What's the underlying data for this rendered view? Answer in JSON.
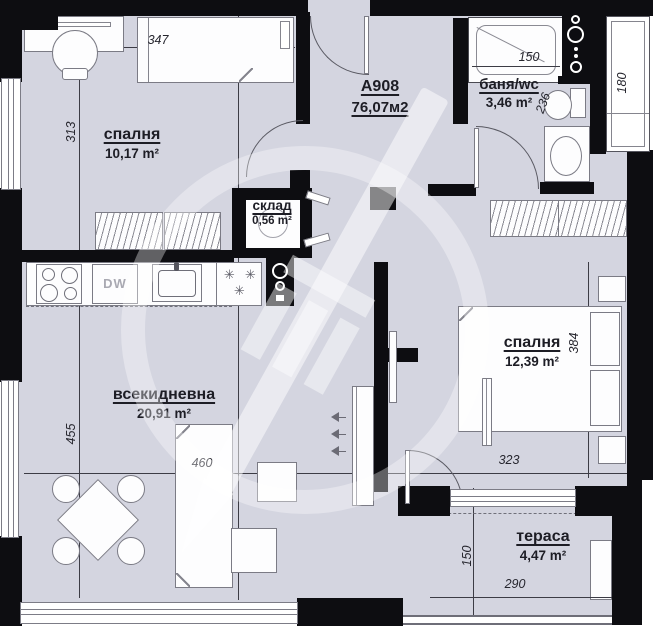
{
  "meta": {
    "plan_code": "A908",
    "total_area": "76,07м2"
  },
  "colors": {
    "wall": "#0d0d11",
    "floor": "#d4d5e0",
    "outline": "#7b7b85",
    "text": "#1d1d25",
    "dim": "#26262e",
    "watermark": "#ffffff"
  },
  "rooms": [
    {
      "id": "bedroom-1",
      "name": "спалня",
      "area": "10,17 m²"
    },
    {
      "id": "bathroom",
      "name": "баня/wc",
      "area": "3,46 m²"
    },
    {
      "id": "storage",
      "name": "склад",
      "area": "0,56 m²"
    },
    {
      "id": "living-room",
      "name": "всекидневна",
      "area": "20,91 m²"
    },
    {
      "id": "bedroom-2",
      "name": "спалня",
      "area": "12,39 m²"
    },
    {
      "id": "terrace",
      "name": "тераса",
      "area": "4,47 m²"
    }
  ],
  "dimensions": {
    "bedroom1_bed_width": "347",
    "bedroom1_depth": "313",
    "bath_tub_length": "150",
    "bath_depth": "236",
    "shaft_width": "180",
    "living_depth": "455",
    "living_width": "460",
    "bedroom2_width": "323",
    "bedroom2_depth": "384",
    "terrace_depth": "150",
    "terrace_width": "290"
  },
  "appliances": {
    "dishwasher_label": "DW"
  }
}
